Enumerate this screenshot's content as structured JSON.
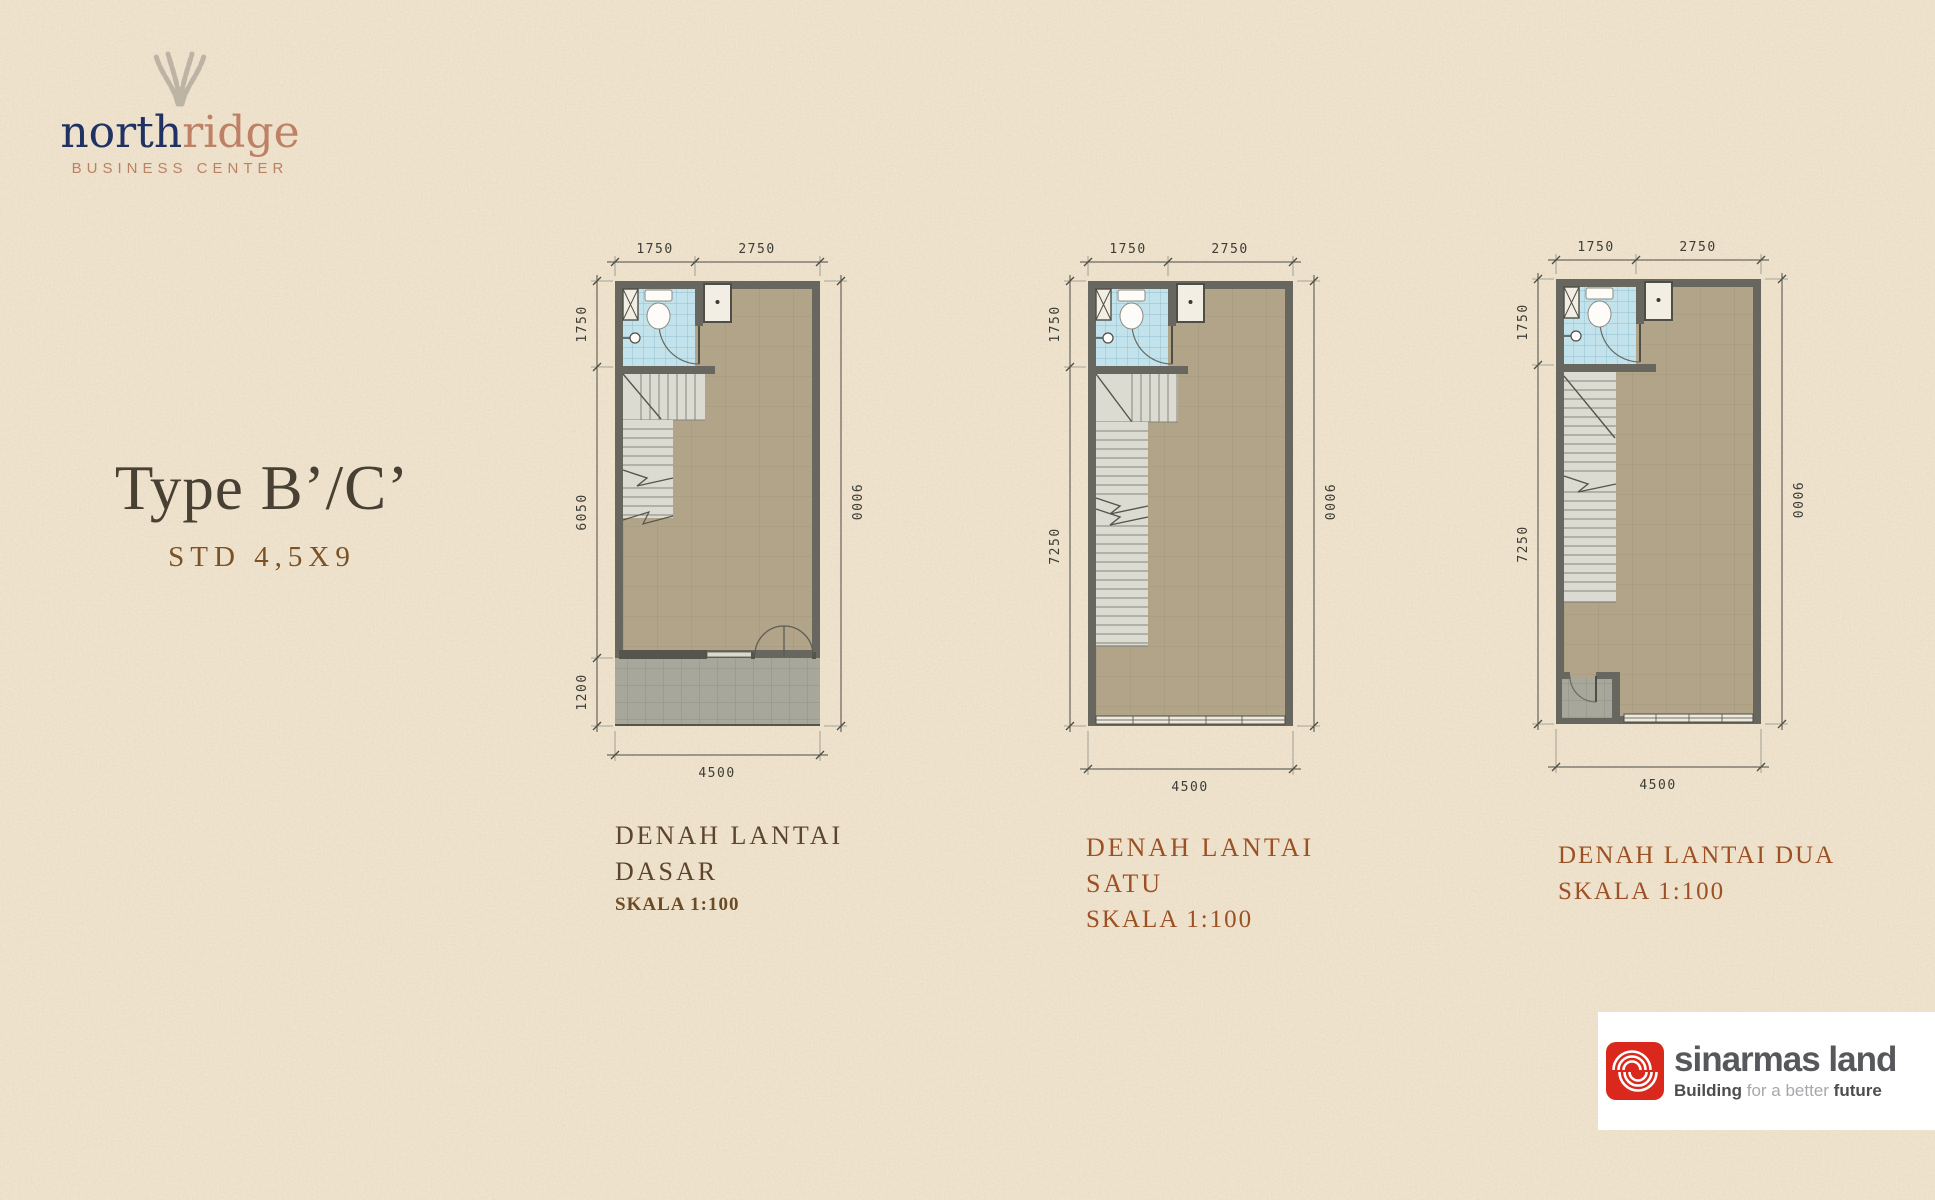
{
  "brand": {
    "word_primary": "north",
    "word_secondary": "ridge",
    "tagline": "BUSINESS CENTER"
  },
  "title": {
    "main": "Type B’/C’",
    "spec": "STD 4,5X9"
  },
  "plans": [
    {
      "caption_line1": "DENAH LANTAI",
      "caption_line2": "DASAR",
      "scale_label": "SKALA 1:100",
      "dims": {
        "top_left": "1750",
        "top_right": "2750",
        "left_top": "1750",
        "left_mid": "6050",
        "left_bottom": "1200",
        "right_side": "9000",
        "bottom": "4500"
      }
    },
    {
      "caption_line1": "DENAH LANTAI",
      "caption_line2": "SATU",
      "scale_label": "SKALA 1:100",
      "dims": {
        "top_left": "1750",
        "top_right": "2750",
        "left_top": "1750",
        "left_main": "7250",
        "right_side": "9000",
        "bottom": "4500"
      }
    },
    {
      "caption_line1": "DENAH LANTAI DUA",
      "scale_label": "SKALA 1:100",
      "dims": {
        "top_left": "1750",
        "top_right": "2750",
        "left_top": "1750",
        "left_main": "7250",
        "right_side": "9000",
        "bottom": "4500"
      }
    }
  ],
  "footer_brand": {
    "wordmark": "sinarmas land",
    "tagline_lead": "Building",
    "tagline_mid": "for a better",
    "tagline_tail": "future"
  },
  "colors": {
    "brand_navy": "#203264",
    "brand_terracotta": "#bf8165",
    "caption_brown": "#5c452c",
    "caption_sienna": "#9c5124",
    "floor_tan": "#b1a489",
    "bath_blue": "#c2e2ec",
    "wall_gray": "#67675f",
    "sinarmas_red": "#da291c",
    "paper": "#ecdfc8"
  }
}
